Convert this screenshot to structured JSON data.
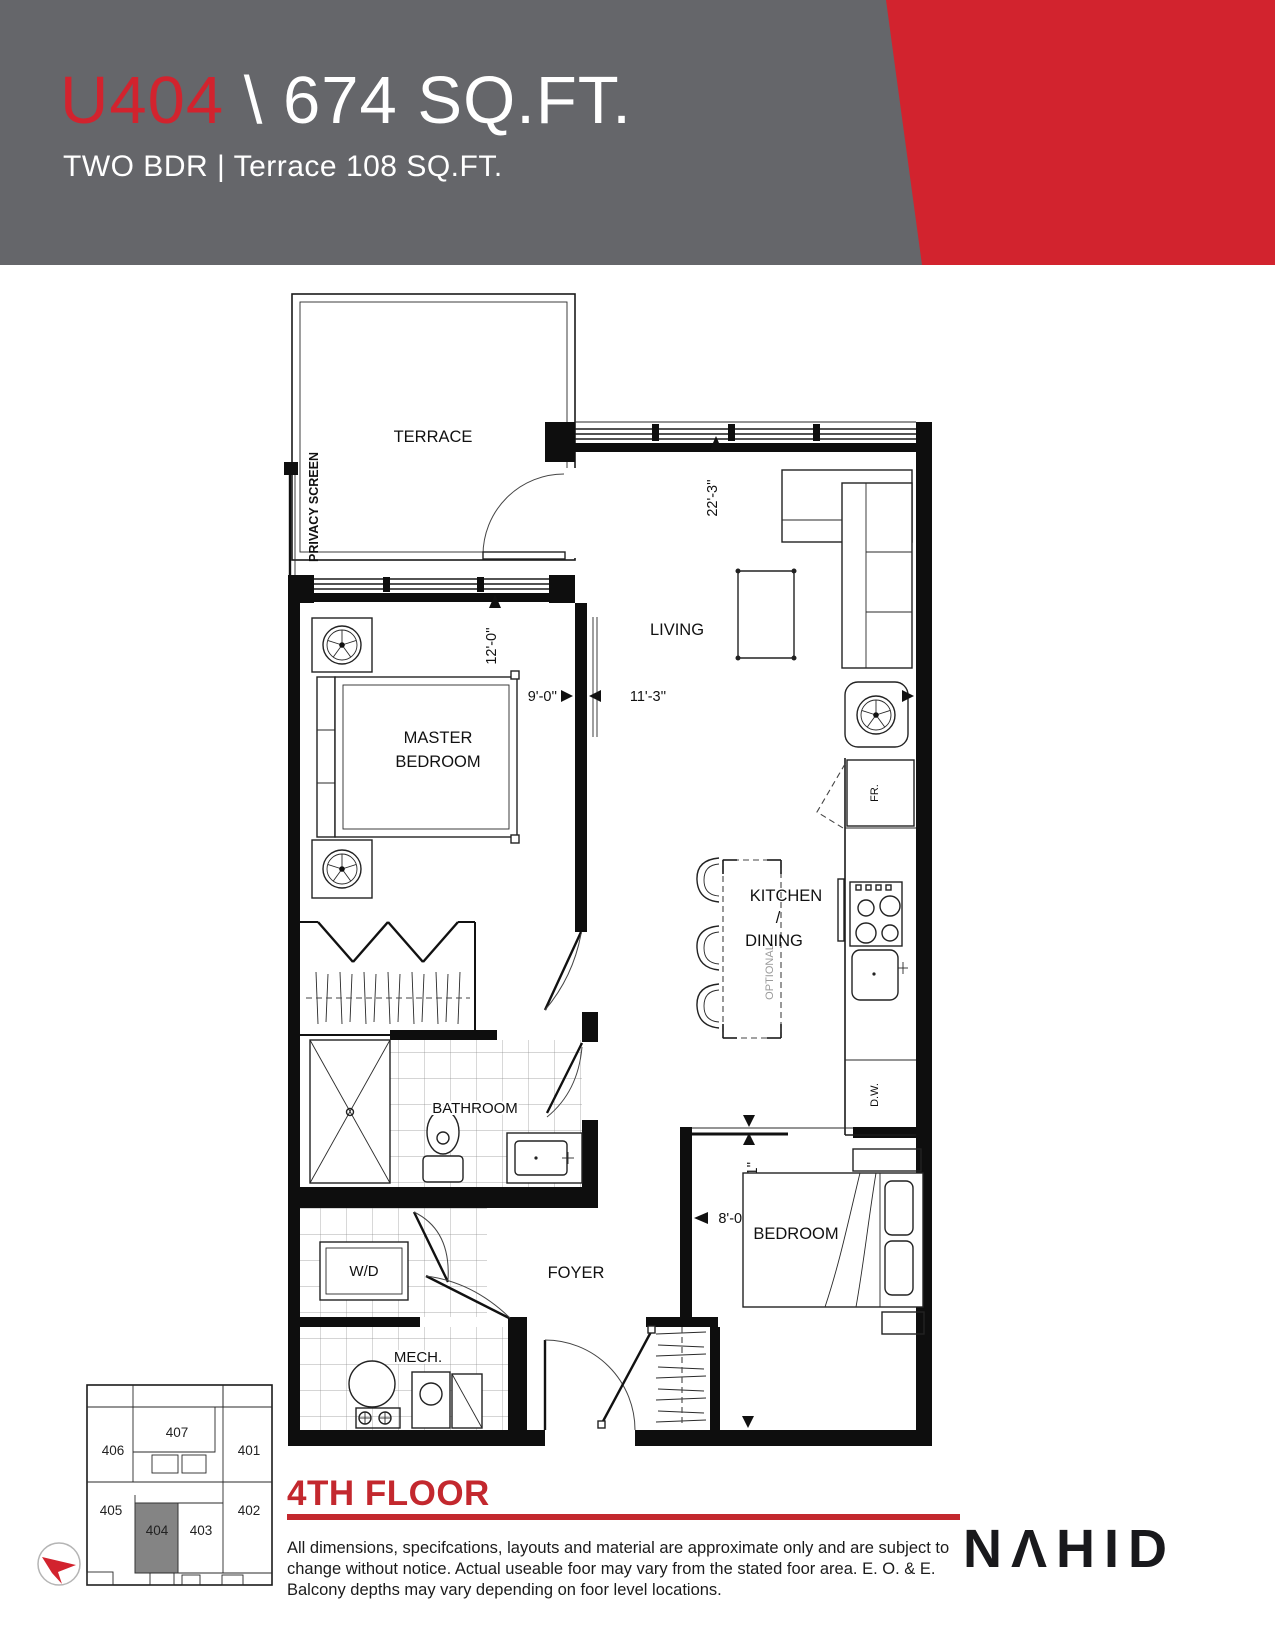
{
  "header": {
    "unit": "U404",
    "rest": "\\ 674 SQ.FT.",
    "subtitle": "TWO BDR | Terrace 108 SQ.FT."
  },
  "plan": {
    "rooms": {
      "terrace": "TERRACE",
      "living": "LIVING",
      "master_line1": "MASTER",
      "master_line2": "BEDROOM",
      "kitchen": "KITCHEN",
      "kitchen_dining_divider": "/",
      "dining": "DINING",
      "bathroom": "BATHROOM",
      "laundry": "W/D",
      "foyer": "FOYER",
      "mech": "MECH.",
      "bedroom": "BEDROOM"
    },
    "labels": {
      "privacy_screen": "PRIVACY SCREEN",
      "optional": "OPTIONAL",
      "fridge": "FR.",
      "dishwasher": "D.W."
    },
    "dims": {
      "living_length": "22'-3''",
      "master_depth": "12'-0''",
      "master_width": "9'-0''",
      "living_width": "11'-3''",
      "bedroom_depth": "9'-11''",
      "bedroom_width": "8'-0''"
    }
  },
  "keyplan": {
    "u401": "401",
    "u402": "402",
    "u403": "403",
    "u404": "404",
    "u405": "405",
    "u406": "406",
    "u407": "407"
  },
  "footer": {
    "floor_title": "4TH FLOOR",
    "disclaimer": "All dimensions, specifcations, layouts and material are approximate only and are subject to change without notice. Actual useable foor may vary from the stated foor area. E. O. & E. Balcony depths may vary depending on foor level locations.",
    "logo": "NΛHID"
  },
  "colors": {
    "banner_gray": "#65666a",
    "brand_red": "#d2232e",
    "footer_red": "#c3282e",
    "keyplan_highlight": "#848484"
  }
}
